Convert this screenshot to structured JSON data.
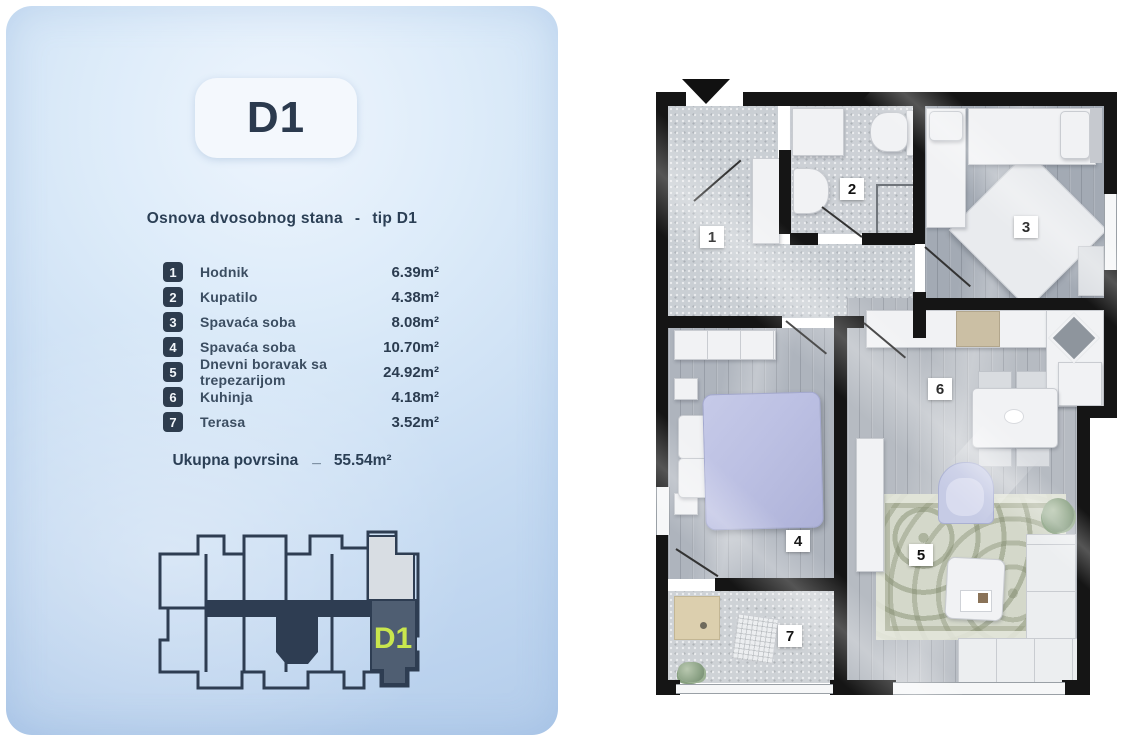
{
  "panel": {
    "badge_label": "D1",
    "subtitle": {
      "text_left": "Osnova dvosobnog stana",
      "dash": "-",
      "text_right": "tip D1"
    },
    "rooms": [
      {
        "num": "1",
        "label": "Hodnik",
        "area": "6.39m²"
      },
      {
        "num": "2",
        "label": "Kupatilo",
        "area": "4.38m²"
      },
      {
        "num": "3",
        "label": "Spavaća soba",
        "area": "8.08m²"
      },
      {
        "num": "4",
        "label": "Spavaća soba",
        "area": "10.70m²"
      },
      {
        "num": "5",
        "label": "Dnevni boravak sa trepezarijom",
        "area": "24.92m²"
      },
      {
        "num": "6",
        "label": "Kuhinja",
        "area": "4.18m²"
      },
      {
        "num": "7",
        "label": "Terasa",
        "area": "3.52m²"
      }
    ],
    "total": {
      "label": "Ukupna povrsina",
      "separator": "_",
      "value": "55.54m²"
    },
    "keyplan": {
      "unit_label": "D1"
    }
  },
  "floorplan": {
    "labels": [
      "1",
      "2",
      "3",
      "4",
      "5",
      "6",
      "7"
    ]
  },
  "icons": {
    "entrance_arrow": "down-triangle"
  },
  "colors": {
    "navy_text": "#2b3c50",
    "badge_navy": "#2d3c4e",
    "card_blue": "#c6dbf2",
    "keyplan_outline": "#2e3d52",
    "keyplan_unit_fill": "#4f5e72",
    "keyplan_unit_label": "#c9e64d",
    "keyplan_neighbor_fill": "#d8dde3",
    "wall_black": "#151515",
    "duvet_lavender": "#bcc0e3"
  }
}
